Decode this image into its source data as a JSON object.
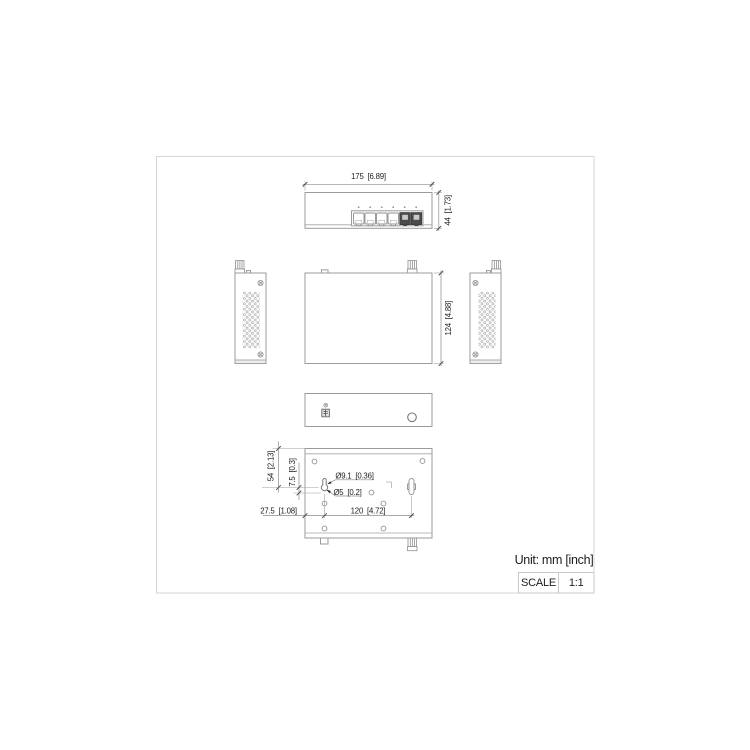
{
  "page": {
    "unit_note": "Unit: mm [inch]",
    "scale": {
      "label": "SCALE",
      "value": "1:1"
    }
  },
  "views": {
    "front": {
      "dim_width": "175  [6.89]",
      "dim_height": "44  [1.73]",
      "rj45_port_count": 4,
      "uplink_port_count": 2
    },
    "top": {
      "dim_depth": "124  [4.88]"
    },
    "bottom": {
      "hole_large": "Ø9.1  [0.36]",
      "hole_small": "Ø5  [0.2]",
      "dim_offset_v": "54  [2.13]",
      "dim_offset_v2": "7.5  [0.3]",
      "dim_offset_h": "27.5  [1.08]",
      "dim_spacing": "120  [4.72]"
    }
  },
  "colors": {
    "line": "#9b9b9b",
    "dim_line": "#8c8c8c",
    "text": "#1c1c1c",
    "frame": "#d6d6d6",
    "port_dark": "#4a4a4a"
  }
}
